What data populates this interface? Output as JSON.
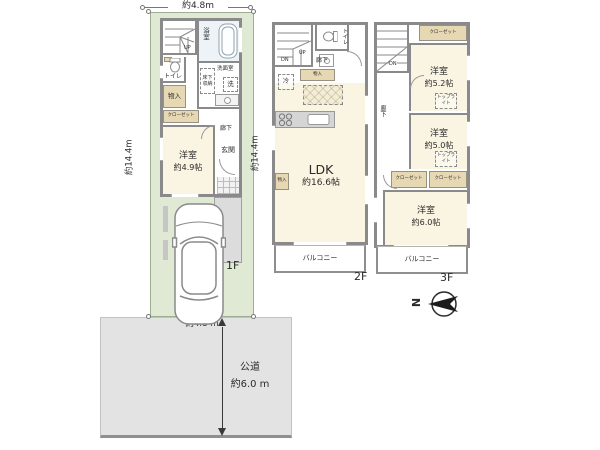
{
  "site": {
    "width_top": "約4.8m",
    "depth_left_1f": "約14.4m",
    "depth_left_2f": "約14.4m",
    "width_bottom": "約4.8 m",
    "road": {
      "name": "公道",
      "width": "約6.0 m"
    },
    "compass_north": "N"
  },
  "floor1": {
    "label": "1F",
    "bath": "浴室",
    "stairs_up": "UP",
    "toilet": "トイレ",
    "storage": "物入",
    "closet": "クローゼット",
    "underfloor_storage": "床下収納",
    "washroom": "洗面室",
    "washer": "洗",
    "bedroom_name": "洋室",
    "bedroom_size": "約4.9帖",
    "entrance": "玄関",
    "hallway": "廊下"
  },
  "floor2": {
    "label": "2F",
    "stairs_up": "UP",
    "stairs_down": "DN",
    "toilet": "トイレ",
    "hallway": "廊下",
    "storage": "物入",
    "fridge": "冷",
    "ldk_name": "LDK",
    "ldk_size": "約16.6帖",
    "wall_storage": "物入",
    "balcony": "バルコニー"
  },
  "floor3": {
    "label": "3F",
    "stairs_down": "DN",
    "closet": "クローゼット",
    "bedroom1_name": "洋室",
    "bedroom1_size": "約5.2帖",
    "toplight": "トップライト",
    "hallway": "廊下",
    "bedroom2_name": "洋室",
    "bedroom2_size": "約5.0帖",
    "bedroom3_name": "洋室",
    "bedroom3_size": "約6.0帖",
    "balcony": "バルコニー"
  },
  "colors": {
    "plot_green": "#dfe9d3",
    "floor_cream": "#faf4e2",
    "closet_tan": "#e6d8b2",
    "wall_gray": "#8a8a8a",
    "road_gray": "#e3e3e3",
    "bath_blue": "#edf3f6"
  }
}
